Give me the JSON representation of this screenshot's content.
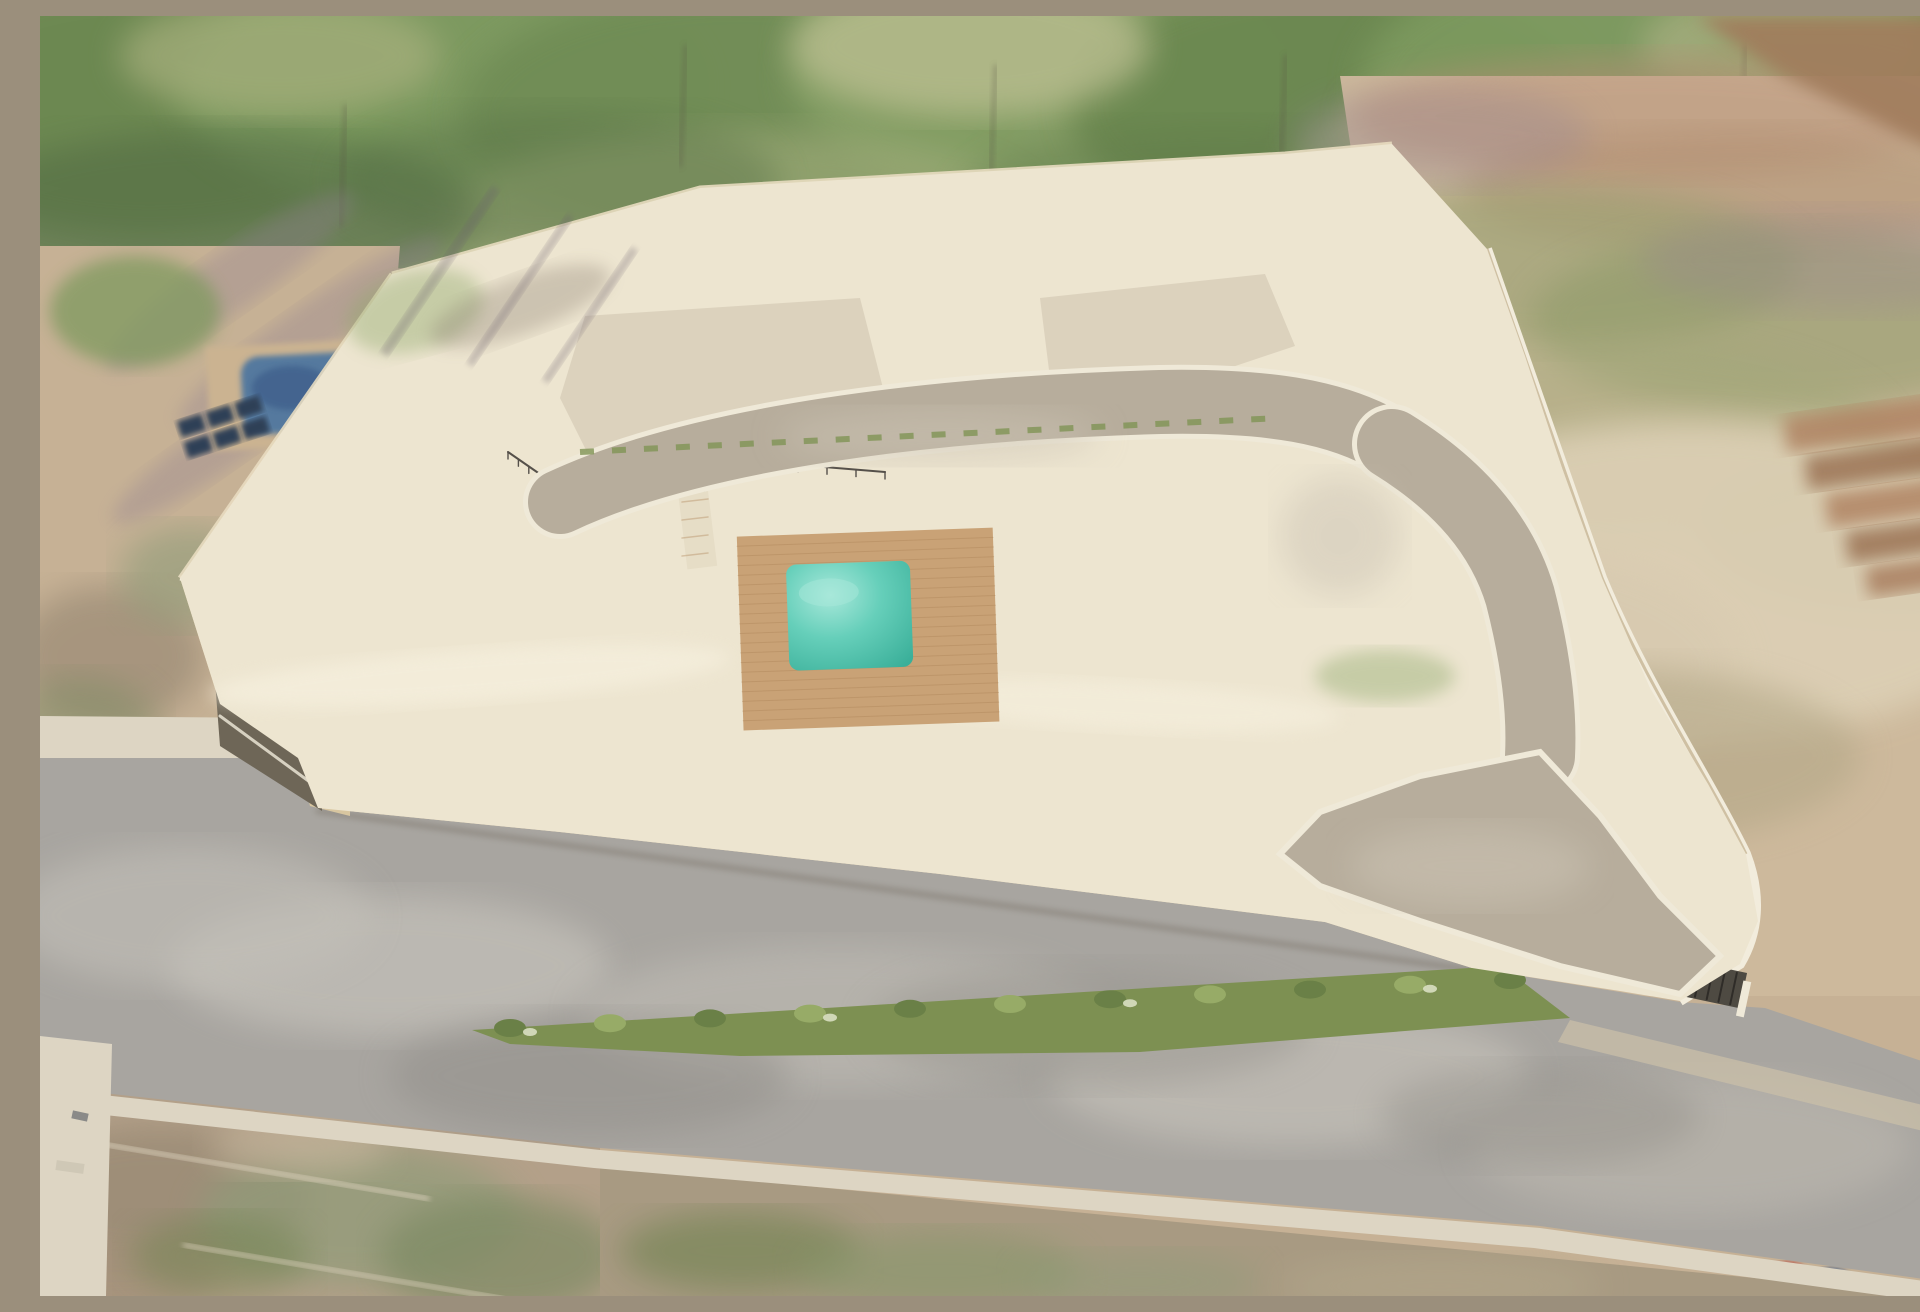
{
  "title": "Aerial 3D rendering of a gated villa development",
  "scene": {
    "description": "Photorealistic aerial architectural rendering of a walled residential compound with modern white villas, terracotta hipped roofs and white flat-roof volumes, a turquoise communal pool with timber deck, slatted white pergola carports, a curving internal driveway, vine-draped retaining walls, and a public road below with cars, a cyclist and pedestrians. Blurred scrubland, trees and neighbouring plots surround the site.",
    "buildings": {
      "villa_count": 10,
      "back_row_clusters": 5,
      "front_row_villas": 3,
      "styles": [
        "white render facades",
        "terracotta hipped roofs",
        "white flat-roof volumes",
        "glass balustrade balconies",
        "slatted pergola carports"
      ]
    },
    "amenities": [
      "communal swimming pool",
      "timber pool deck",
      "sun loungers",
      "private plunge pools",
      "carports",
      "white pergolas",
      "vine-draped retaining wall",
      "underground garage ramp",
      "entrance gate"
    ],
    "vehicles": [
      {
        "type": "suv",
        "color": "white",
        "location": "internal driveway near exit gate"
      },
      {
        "type": "hatchback",
        "color": "dark gray",
        "location": "street below retaining wall"
      },
      {
        "type": "van",
        "color": "white",
        "location": "public road lower left"
      },
      {
        "type": "crossover",
        "color": "gray",
        "location": "public road lower right"
      },
      {
        "type": "car",
        "color": "dark gray",
        "location": "carport under central pergola"
      },
      {
        "type": "car",
        "color": "white",
        "location": "carport under central pergola"
      },
      {
        "type": "car",
        "color": "white",
        "location": "carport by right rear villas"
      },
      {
        "type": "car",
        "color": "white",
        "location": "carport by right rear villas"
      },
      {
        "type": "car",
        "color": "dark gray",
        "location": "under front-left pergola"
      }
    ],
    "people": [
      {
        "role": "swimmer in communal pool",
        "shirt": "#d9a77e"
      },
      {
        "role": "person seated on pool deck",
        "shirt": "#6a6a6e"
      },
      {
        "role": "resident on balcony",
        "shirt": "#c0392b"
      },
      {
        "role": "resident on balcony",
        "shirt": "#3f5d8a"
      },
      {
        "role": "resident walking on footpath",
        "shirt": "#444a50"
      },
      {
        "role": "resident on rear terrace",
        "shirt": "#7d8a93"
      },
      {
        "role": "driver beside parked car",
        "shirt": "#50555a"
      },
      {
        "role": "pedestrian at entrance gate",
        "shirt": "#f0efea"
      },
      {
        "role": "cyclist on public road",
        "shirt": "#5a6066"
      },
      {
        "role": "pedestrian on public road",
        "shirt": "#8a5560"
      },
      {
        "role": "pedestrian on public road",
        "shirt": "#4a5a6a"
      },
      {
        "role": "pedestrian on sidewalk",
        "shirt": "#6a6258"
      },
      {
        "role": "pedestrian near left curb",
        "shirt": "#3a3f45"
      },
      {
        "role": "resident by private plunge pool",
        "shirt": "#d0cec8"
      }
    ],
    "environment": [
      "mature trees",
      "palm trees",
      "scrubland",
      "neighbouring plots",
      "solar panels",
      "neighbouring swimming pool",
      "public roads",
      "hedge median"
    ]
  },
  "palette": {
    "terrain_tan": "#c6b195",
    "terrain_light": "#dbcdb3",
    "green_dark": "#54703f",
    "green_mid": "#6f8c54",
    "green_light": "#93a871",
    "green_dry": "#b6ba8c",
    "olive": "#8e9a6e",
    "dirt_brown": "#a07c5b",
    "shadow_purple": "#8f7e90",
    "road_asphalt": "#a8a5a0",
    "road_light": "#c2bfb8",
    "road_dark": "#918e89",
    "sidewalk": "#ddd5c3",
    "ground_cream": "#ede5d0",
    "ground_bright": "#f5efdf",
    "court_pave": "#d9cfba",
    "wall_lit": "#e7d7b4",
    "wall_shade": "#d3bf99",
    "wall_dark": "#b7a37d",
    "ramp_dark": "#6e6657",
    "vine_green": "#a2b164",
    "vine_dark": "#7b8f4e",
    "villa_white": "#f8f5ee",
    "villa_shade": "#e5ddcd",
    "villa_deep": "#d5cab6",
    "window_dark": "#6f7569",
    "window_warm": "#8a7b5e",
    "roof_terracotta": "#c58a5c",
    "roof_terracotta_dark": "#a96b44",
    "roof_ridge": "#dca273",
    "flat_roof": "#ececea",
    "flat_roof_rib": "#d7d7d3",
    "pool_teal": "#66cfba",
    "pool_deep": "#3aaf99",
    "pool_light": "#a8e8da",
    "deck_wood": "#c9a276",
    "deck_line": "#b28a5e",
    "car_dark": "#46464a",
    "car_white": "#f2f1ee",
    "car_gray": "#a09e99",
    "metal_dark": "#55504a",
    "skin": "#d9a77e"
  }
}
